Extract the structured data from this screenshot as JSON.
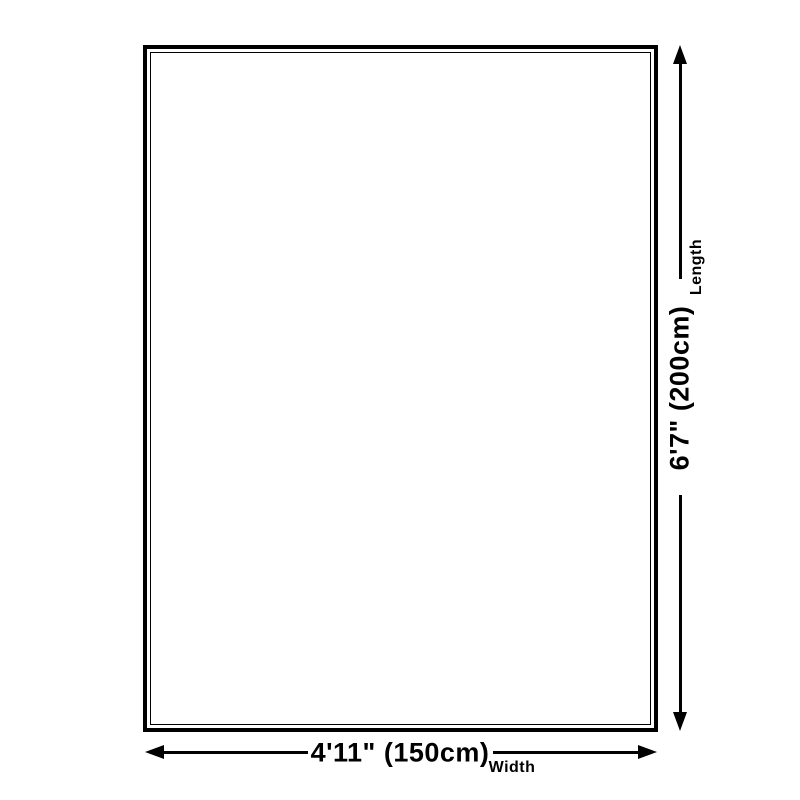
{
  "diagram": {
    "background_color": "#ffffff",
    "line_color": "#000000",
    "shape": "rectangle-outline",
    "length_dimension": {
      "value": "6'7\" (200cm)",
      "label": "Length"
    },
    "width_dimension": {
      "value": "4'11\" (150cm)",
      "label": "Width"
    }
  }
}
